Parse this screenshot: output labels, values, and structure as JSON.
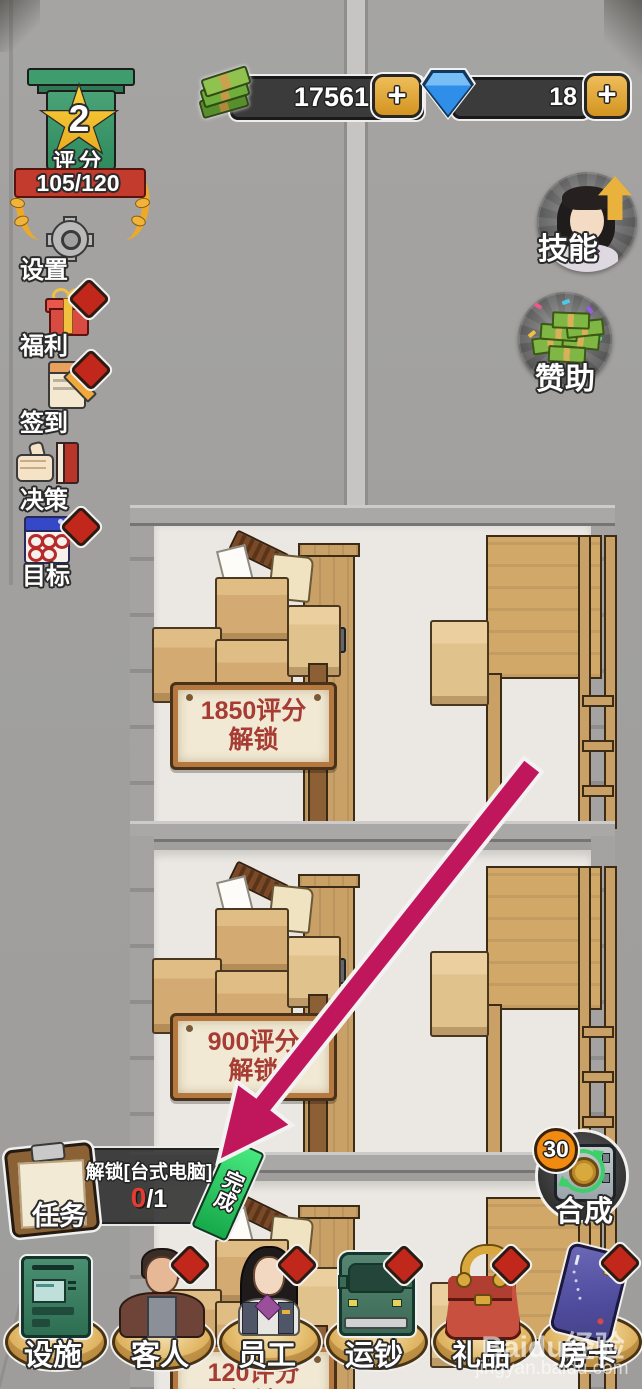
{
  "hud": {
    "rating": {
      "level": "2",
      "label": "评分",
      "score": "105/120"
    },
    "money": {
      "value": "17561",
      "plus": "+",
      "icon": "cash-bundle-icon"
    },
    "diamonds": {
      "value": "18",
      "plus": "+",
      "icon": "gem-icon"
    },
    "sidebar": {
      "items": [
        {
          "id": "settings",
          "label": "设置",
          "icon": "gear-icon",
          "has_badge": false
        },
        {
          "id": "welfare",
          "label": "福利",
          "icon": "gift-icon",
          "has_badge": true
        },
        {
          "id": "checkin",
          "label": "签到",
          "icon": "notepad-pencil-icon",
          "has_badge": true
        },
        {
          "id": "decision",
          "label": "决策",
          "icon": "thumbs-up-book-icon",
          "has_badge": false
        },
        {
          "id": "goal",
          "label": "目标",
          "icon": "calendar-icon",
          "has_badge": true
        }
      ]
    },
    "skill": {
      "label": "技能",
      "icon": "staff-avatar-up-arrow-icon"
    },
    "sponsor": {
      "label": "赞助",
      "icon": "money-pile-icon"
    },
    "task": {
      "label": "任务",
      "title": "解锁[台式电脑]",
      "progress_current": "0",
      "progress_rest": "/1",
      "ribbon": "完成"
    },
    "synthesis": {
      "label": "合成",
      "badge": "30",
      "icon": "safe-recycle-icon"
    },
    "bottom_bar": {
      "items": [
        {
          "id": "facility",
          "label": "设施",
          "icon": "atm-icon",
          "has_badge": false
        },
        {
          "id": "guest",
          "label": "客人",
          "icon": "male-guest-icon",
          "has_badge": true
        },
        {
          "id": "staff",
          "label": "员工",
          "icon": "female-staff-icon",
          "has_badge": true
        },
        {
          "id": "cash-truck",
          "label": "运钞",
          "icon": "van-icon",
          "has_badge": true
        },
        {
          "id": "gift",
          "label": "礼品",
          "icon": "handbag-icon",
          "has_badge": true
        },
        {
          "id": "room-card",
          "label": "房卡",
          "icon": "card-icon",
          "has_badge": true
        }
      ]
    }
  },
  "scene": {
    "signs": [
      {
        "line1": "1850评分",
        "line2": "解锁"
      },
      {
        "line1": "900评分",
        "line2": "解锁"
      },
      {
        "line1": "120评分",
        "line2": "解锁"
      }
    ],
    "tutorial_arrow": {
      "color": "#c0175c",
      "points_to": "task-complete-ribbon"
    }
  },
  "watermark": {
    "brand": "Baidu经验",
    "url": "jingyan.baidu.com"
  },
  "colors": {
    "accent_gold": "#dfa83e",
    "badge_red": "#c1271b",
    "ribbon_green": "#2ed467",
    "sign_text": "#a63c33",
    "arrow": "#c0175c",
    "bar_dark": "#3b3b3b"
  }
}
